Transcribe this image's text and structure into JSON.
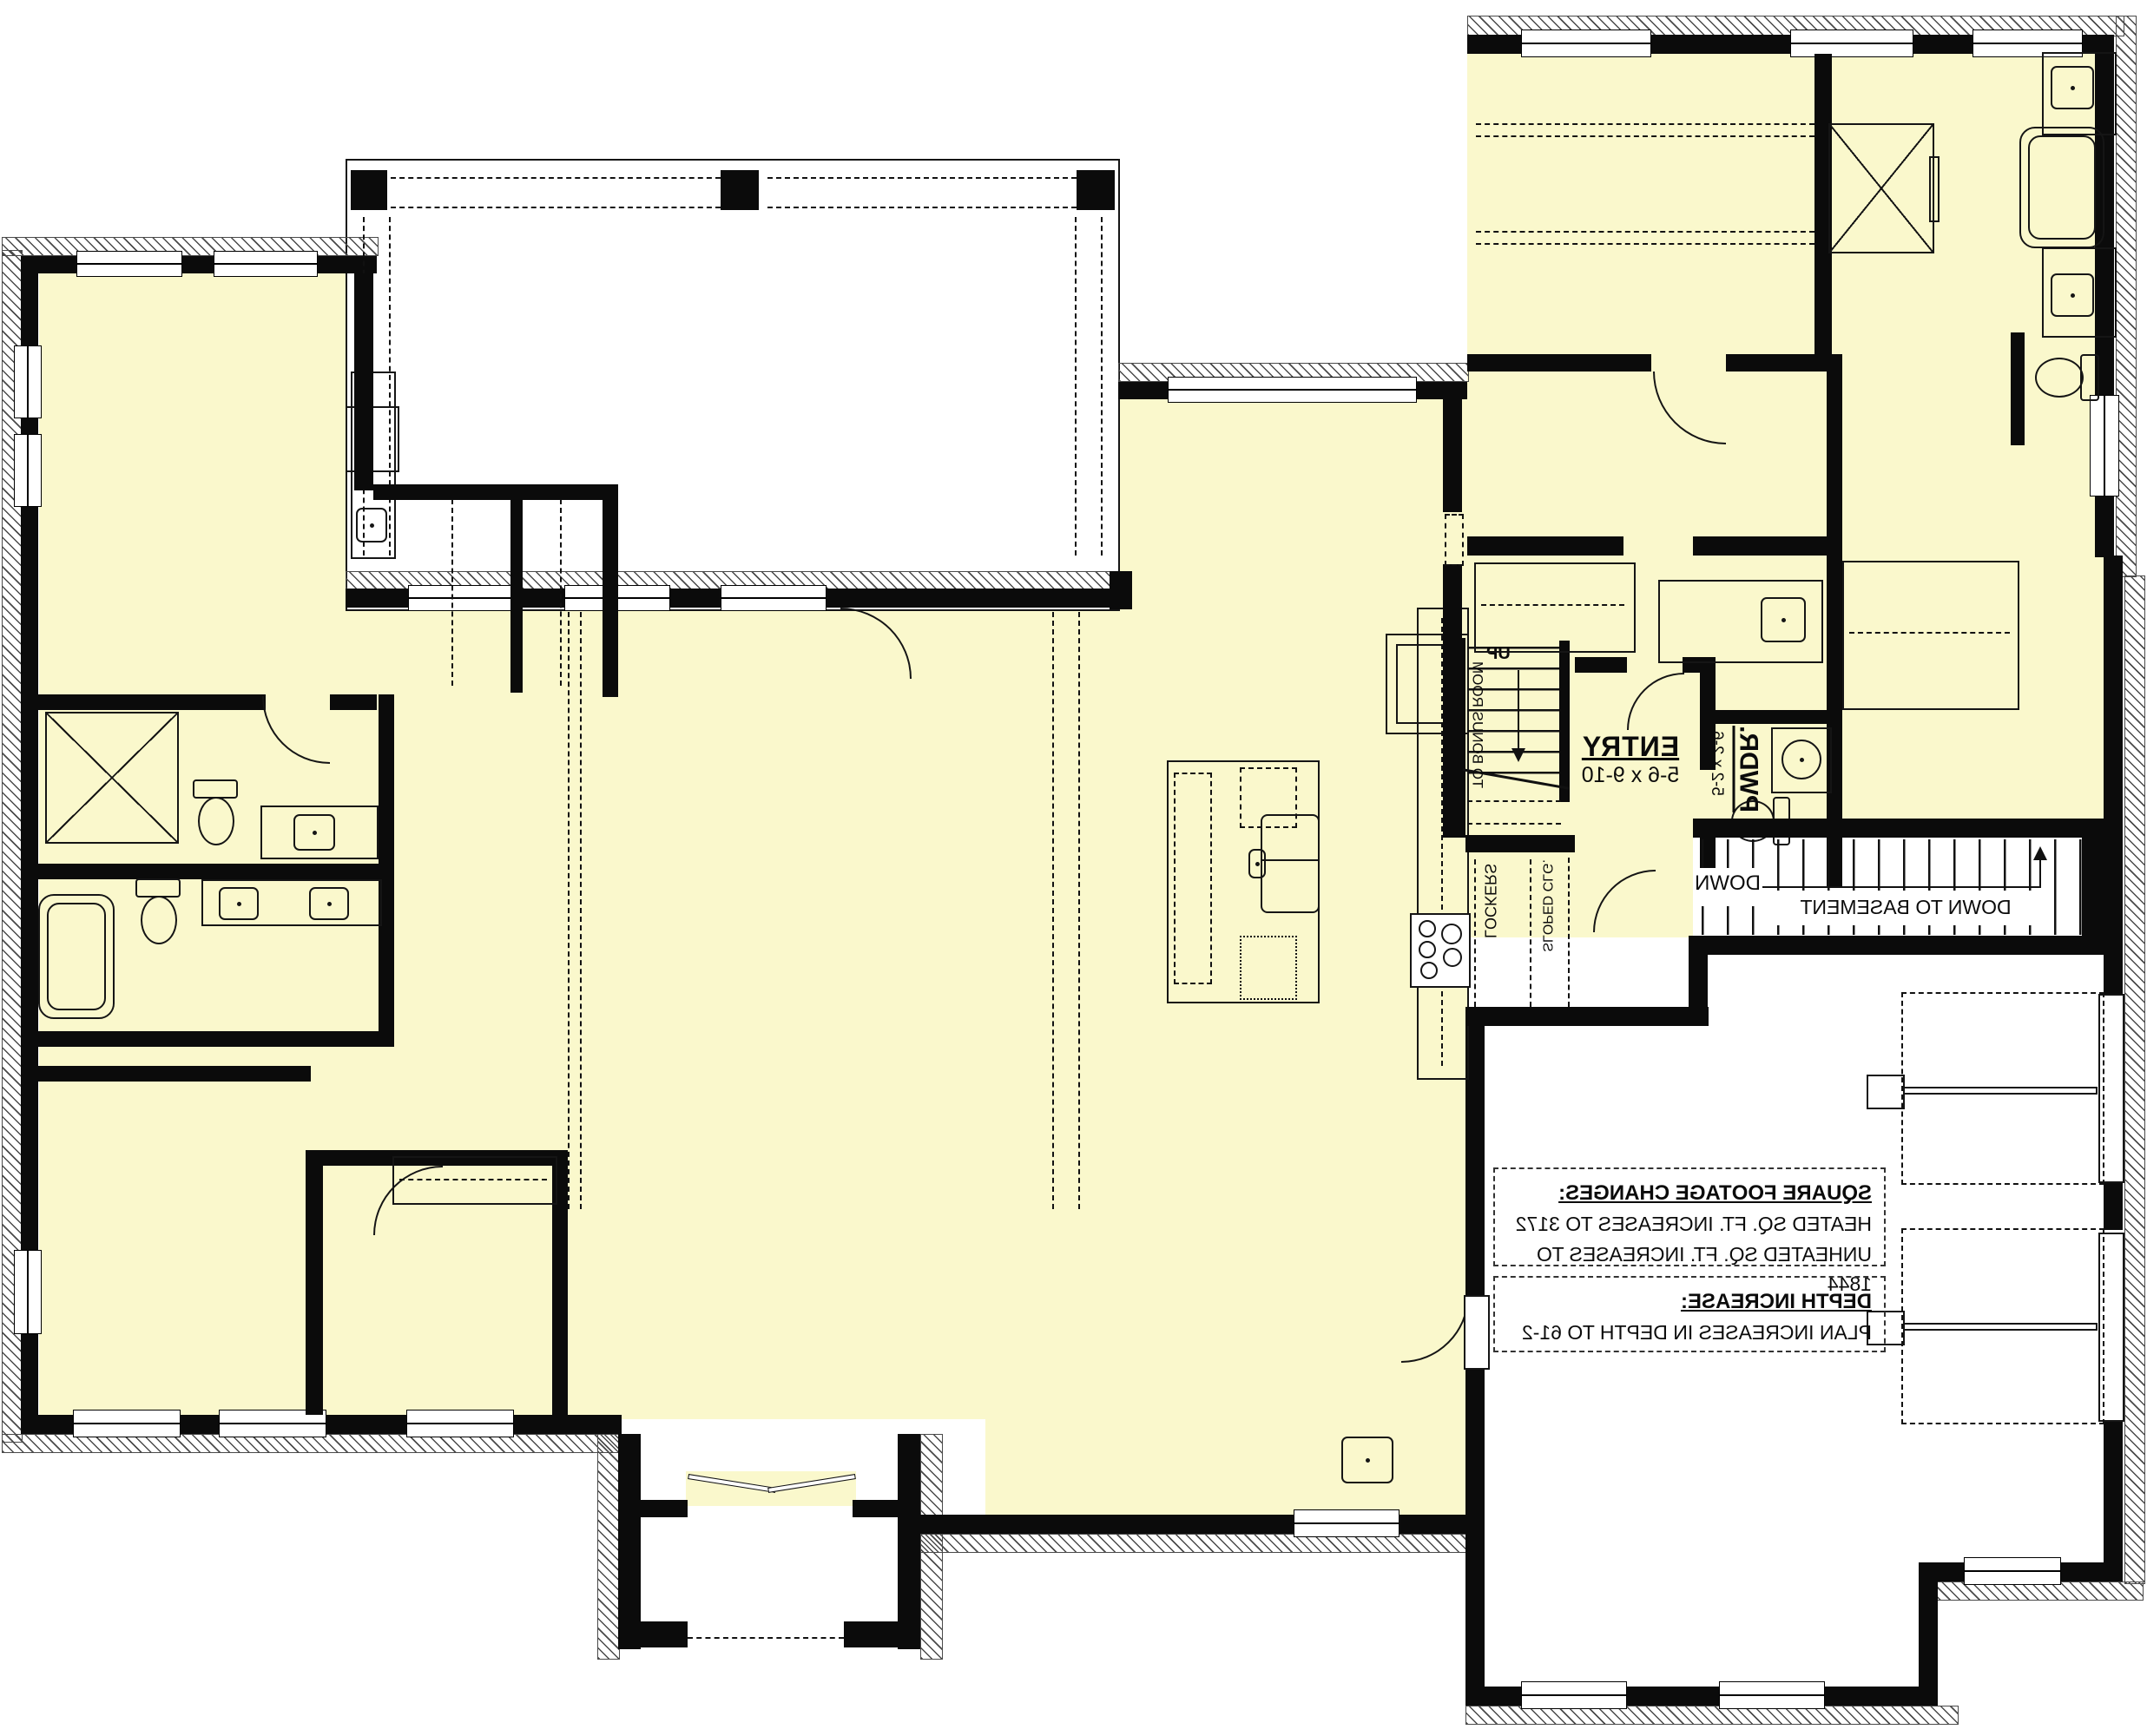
{
  "labels": {
    "entry": {
      "name": "ENTRY",
      "dims": "5-6 x 9-10"
    },
    "powder": {
      "name": "PWDR.",
      "dims": "5-2 x 2-6"
    },
    "bonus_stairs": {
      "direction": "UP",
      "destination": "TO BONUS ROOM"
    },
    "basement_stairs": {
      "direction": "DOWN",
      "note": "DOWN TO BASEMENT"
    },
    "lockers": "LOCKERS",
    "sloped_ceiling": "SLOPED CLG."
  },
  "notes": {
    "square_footage": {
      "heading": "SQUARE FOOTAGE CHANGES:",
      "lines": [
        "HEATED SQ. FT. INCREASES TO 3172",
        "UNHEATED SQ. FT. INCREASES TO 1844"
      ]
    },
    "depth": {
      "heading": "DEPTH INCREASE:",
      "lines": [
        "PLAN INCREASES IN DEPTH TO 61-2"
      ]
    }
  },
  "colors": {
    "room_fill": "#FAF8CC",
    "wall": "#0B0B0B",
    "background": "#FFFFFF",
    "line": "#151515"
  }
}
